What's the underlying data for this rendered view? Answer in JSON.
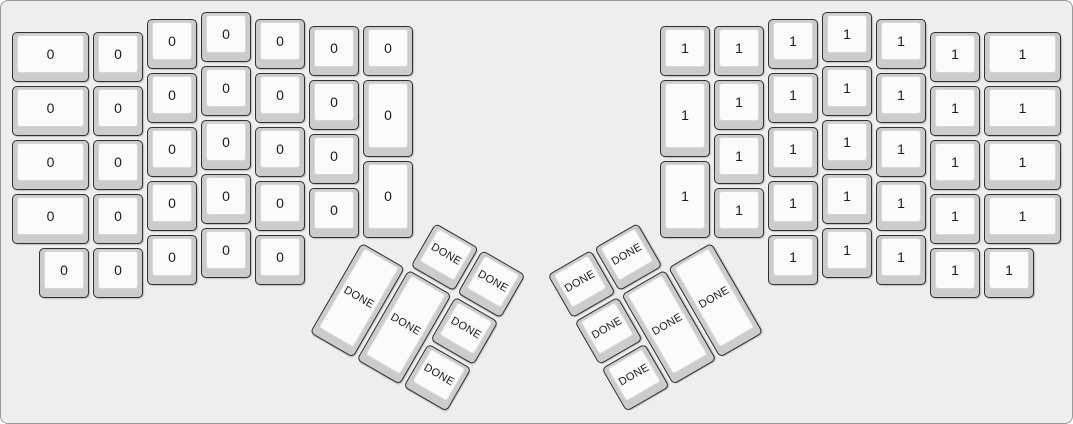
{
  "app": {
    "description": "ErgoDox keyboard layout render",
    "background_color": "#eeeeee"
  },
  "keyboard": {
    "unit_px": 54,
    "origin_x": 9,
    "origin_y": 9,
    "key_gap_px": 2,
    "colors": {
      "canvas_background": "#eeeeee",
      "key_base": "#cccccc",
      "key_face": "#fbfbfb",
      "key_outer_border": "#303030",
      "key_face_border": "#d8d8d8",
      "legend_color": "#1a1a1a"
    },
    "legend_values": {
      "left_half": "0",
      "right_half": "1",
      "thumb_clusters": "DONE"
    },
    "left_main": {
      "keys": [
        {
          "x": 0,
          "y": 0.375,
          "w": 1.5,
          "h": 1,
          "label": "0"
        },
        {
          "x": 1.5,
          "y": 0.375,
          "w": 1,
          "h": 1,
          "label": "0"
        },
        {
          "x": 2.5,
          "y": 0.125,
          "w": 1,
          "h": 1,
          "label": "0"
        },
        {
          "x": 3.5,
          "y": 0,
          "w": 1,
          "h": 1,
          "label": "0"
        },
        {
          "x": 4.5,
          "y": 0.125,
          "w": 1,
          "h": 1,
          "label": "0"
        },
        {
          "x": 5.5,
          "y": 0.25,
          "w": 1,
          "h": 1,
          "label": "0"
        },
        {
          "x": 6.5,
          "y": 0.25,
          "w": 1,
          "h": 1,
          "label": "0"
        },
        {
          "x": 0,
          "y": 1.375,
          "w": 1.5,
          "h": 1,
          "label": "0"
        },
        {
          "x": 1.5,
          "y": 1.375,
          "w": 1,
          "h": 1,
          "label": "0"
        },
        {
          "x": 2.5,
          "y": 1.125,
          "w": 1,
          "h": 1,
          "label": "0"
        },
        {
          "x": 3.5,
          "y": 1,
          "w": 1,
          "h": 1,
          "label": "0"
        },
        {
          "x": 4.5,
          "y": 1.125,
          "w": 1,
          "h": 1,
          "label": "0"
        },
        {
          "x": 5.5,
          "y": 1.25,
          "w": 1,
          "h": 1,
          "label": "0"
        },
        {
          "x": 6.5,
          "y": 1.25,
          "w": 1,
          "h": 1.5,
          "label": "0"
        },
        {
          "x": 0,
          "y": 2.375,
          "w": 1.5,
          "h": 1,
          "label": "0"
        },
        {
          "x": 1.5,
          "y": 2.375,
          "w": 1,
          "h": 1,
          "label": "0"
        },
        {
          "x": 2.5,
          "y": 2.125,
          "w": 1,
          "h": 1,
          "label": "0"
        },
        {
          "x": 3.5,
          "y": 2,
          "w": 1,
          "h": 1,
          "label": "0"
        },
        {
          "x": 4.5,
          "y": 2.125,
          "w": 1,
          "h": 1,
          "label": "0"
        },
        {
          "x": 5.5,
          "y": 2.25,
          "w": 1,
          "h": 1,
          "label": "0"
        },
        {
          "x": 6.5,
          "y": 2.75,
          "w": 1,
          "h": 1.5,
          "label": "0"
        },
        {
          "x": 0,
          "y": 3.375,
          "w": 1.5,
          "h": 1,
          "label": "0"
        },
        {
          "x": 1.5,
          "y": 3.375,
          "w": 1,
          "h": 1,
          "label": "0"
        },
        {
          "x": 2.5,
          "y": 3.125,
          "w": 1,
          "h": 1,
          "label": "0"
        },
        {
          "x": 3.5,
          "y": 3,
          "w": 1,
          "h": 1,
          "label": "0"
        },
        {
          "x": 4.5,
          "y": 3.125,
          "w": 1,
          "h": 1,
          "label": "0"
        },
        {
          "x": 5.5,
          "y": 3.25,
          "w": 1,
          "h": 1,
          "label": "0"
        },
        {
          "x": 0.5,
          "y": 4.375,
          "w": 1,
          "h": 1,
          "label": "0"
        },
        {
          "x": 1.5,
          "y": 4.375,
          "w": 1,
          "h": 1,
          "label": "0"
        },
        {
          "x": 2.5,
          "y": 4.125,
          "w": 1,
          "h": 1,
          "label": "0"
        },
        {
          "x": 3.5,
          "y": 4,
          "w": 1,
          "h": 1,
          "label": "0"
        },
        {
          "x": 4.5,
          "y": 4.125,
          "w": 1,
          "h": 1,
          "label": "0"
        }
      ]
    },
    "right_main": {
      "keys": [
        {
          "x": 18,
          "y": 0.375,
          "w": 1.5,
          "h": 1,
          "label": "1"
        },
        {
          "x": 17,
          "y": 0.375,
          "w": 1,
          "h": 1,
          "label": "1"
        },
        {
          "x": 16,
          "y": 0.125,
          "w": 1,
          "h": 1,
          "label": "1"
        },
        {
          "x": 15,
          "y": 0,
          "w": 1,
          "h": 1,
          "label": "1"
        },
        {
          "x": 14,
          "y": 0.125,
          "w": 1,
          "h": 1,
          "label": "1"
        },
        {
          "x": 13,
          "y": 0.25,
          "w": 1,
          "h": 1,
          "label": "1"
        },
        {
          "x": 12,
          "y": 0.25,
          "w": 1,
          "h": 1,
          "label": "1"
        },
        {
          "x": 18,
          "y": 1.375,
          "w": 1.5,
          "h": 1,
          "label": "1"
        },
        {
          "x": 17,
          "y": 1.375,
          "w": 1,
          "h": 1,
          "label": "1"
        },
        {
          "x": 16,
          "y": 1.125,
          "w": 1,
          "h": 1,
          "label": "1"
        },
        {
          "x": 15,
          "y": 1,
          "w": 1,
          "h": 1,
          "label": "1"
        },
        {
          "x": 14,
          "y": 1.125,
          "w": 1,
          "h": 1,
          "label": "1"
        },
        {
          "x": 13,
          "y": 1.25,
          "w": 1,
          "h": 1,
          "label": "1"
        },
        {
          "x": 12,
          "y": 1.25,
          "w": 1,
          "h": 1.5,
          "label": "1"
        },
        {
          "x": 18,
          "y": 2.375,
          "w": 1.5,
          "h": 1,
          "label": "1"
        },
        {
          "x": 17,
          "y": 2.375,
          "w": 1,
          "h": 1,
          "label": "1"
        },
        {
          "x": 16,
          "y": 2.125,
          "w": 1,
          "h": 1,
          "label": "1"
        },
        {
          "x": 15,
          "y": 2,
          "w": 1,
          "h": 1,
          "label": "1"
        },
        {
          "x": 14,
          "y": 2.125,
          "w": 1,
          "h": 1,
          "label": "1"
        },
        {
          "x": 13,
          "y": 2.25,
          "w": 1,
          "h": 1,
          "label": "1"
        },
        {
          "x": 12,
          "y": 2.75,
          "w": 1,
          "h": 1.5,
          "label": "1"
        },
        {
          "x": 18,
          "y": 3.375,
          "w": 1.5,
          "h": 1,
          "label": "1"
        },
        {
          "x": 17,
          "y": 3.375,
          "w": 1,
          "h": 1,
          "label": "1"
        },
        {
          "x": 16,
          "y": 3.125,
          "w": 1,
          "h": 1,
          "label": "1"
        },
        {
          "x": 15,
          "y": 3,
          "w": 1,
          "h": 1,
          "label": "1"
        },
        {
          "x": 14,
          "y": 3.125,
          "w": 1,
          "h": 1,
          "label": "1"
        },
        {
          "x": 13,
          "y": 3.25,
          "w": 1,
          "h": 1,
          "label": "1"
        },
        {
          "x": 18,
          "y": 4.375,
          "w": 1,
          "h": 1,
          "label": "1"
        },
        {
          "x": 17,
          "y": 4.375,
          "w": 1,
          "h": 1,
          "label": "1"
        },
        {
          "x": 16,
          "y": 4.125,
          "w": 1,
          "h": 1,
          "label": "1"
        },
        {
          "x": 15,
          "y": 4,
          "w": 1,
          "h": 1,
          "label": "1"
        },
        {
          "x": 14,
          "y": 4.125,
          "w": 1,
          "h": 1,
          "label": "1"
        }
      ]
    },
    "left_thumb": {
      "rotation_deg": 30,
      "center_x_units": 6.5,
      "center_y_units": 4.25,
      "keys": [
        {
          "x": 7.5,
          "y": 3.25,
          "w": 1,
          "h": 1,
          "label": "DONE"
        },
        {
          "x": 8.5,
          "y": 3.25,
          "w": 1,
          "h": 1,
          "label": "DONE"
        },
        {
          "x": 6.5,
          "y": 4.25,
          "w": 1,
          "h": 2,
          "label": "DONE"
        },
        {
          "x": 7.5,
          "y": 4.25,
          "w": 1,
          "h": 2,
          "label": "DONE"
        },
        {
          "x": 8.5,
          "y": 4.25,
          "w": 1,
          "h": 1,
          "label": "DONE"
        },
        {
          "x": 8.5,
          "y": 5.25,
          "w": 1,
          "h": 1,
          "label": "DONE"
        }
      ]
    },
    "right_thumb": {
      "rotation_deg": -30,
      "center_x_units": 13,
      "center_y_units": 4.25,
      "keys": [
        {
          "x": 10,
          "y": 3.25,
          "w": 1,
          "h": 1,
          "label": "DONE"
        },
        {
          "x": 11,
          "y": 3.25,
          "w": 1,
          "h": 1,
          "label": "DONE"
        },
        {
          "x": 12,
          "y": 4.25,
          "w": 1,
          "h": 2,
          "label": "DONE"
        },
        {
          "x": 11,
          "y": 4.25,
          "w": 1,
          "h": 2,
          "label": "DONE"
        },
        {
          "x": 10,
          "y": 4.25,
          "w": 1,
          "h": 1,
          "label": "DONE"
        },
        {
          "x": 10,
          "y": 5.25,
          "w": 1,
          "h": 1,
          "label": "DONE"
        }
      ]
    }
  }
}
